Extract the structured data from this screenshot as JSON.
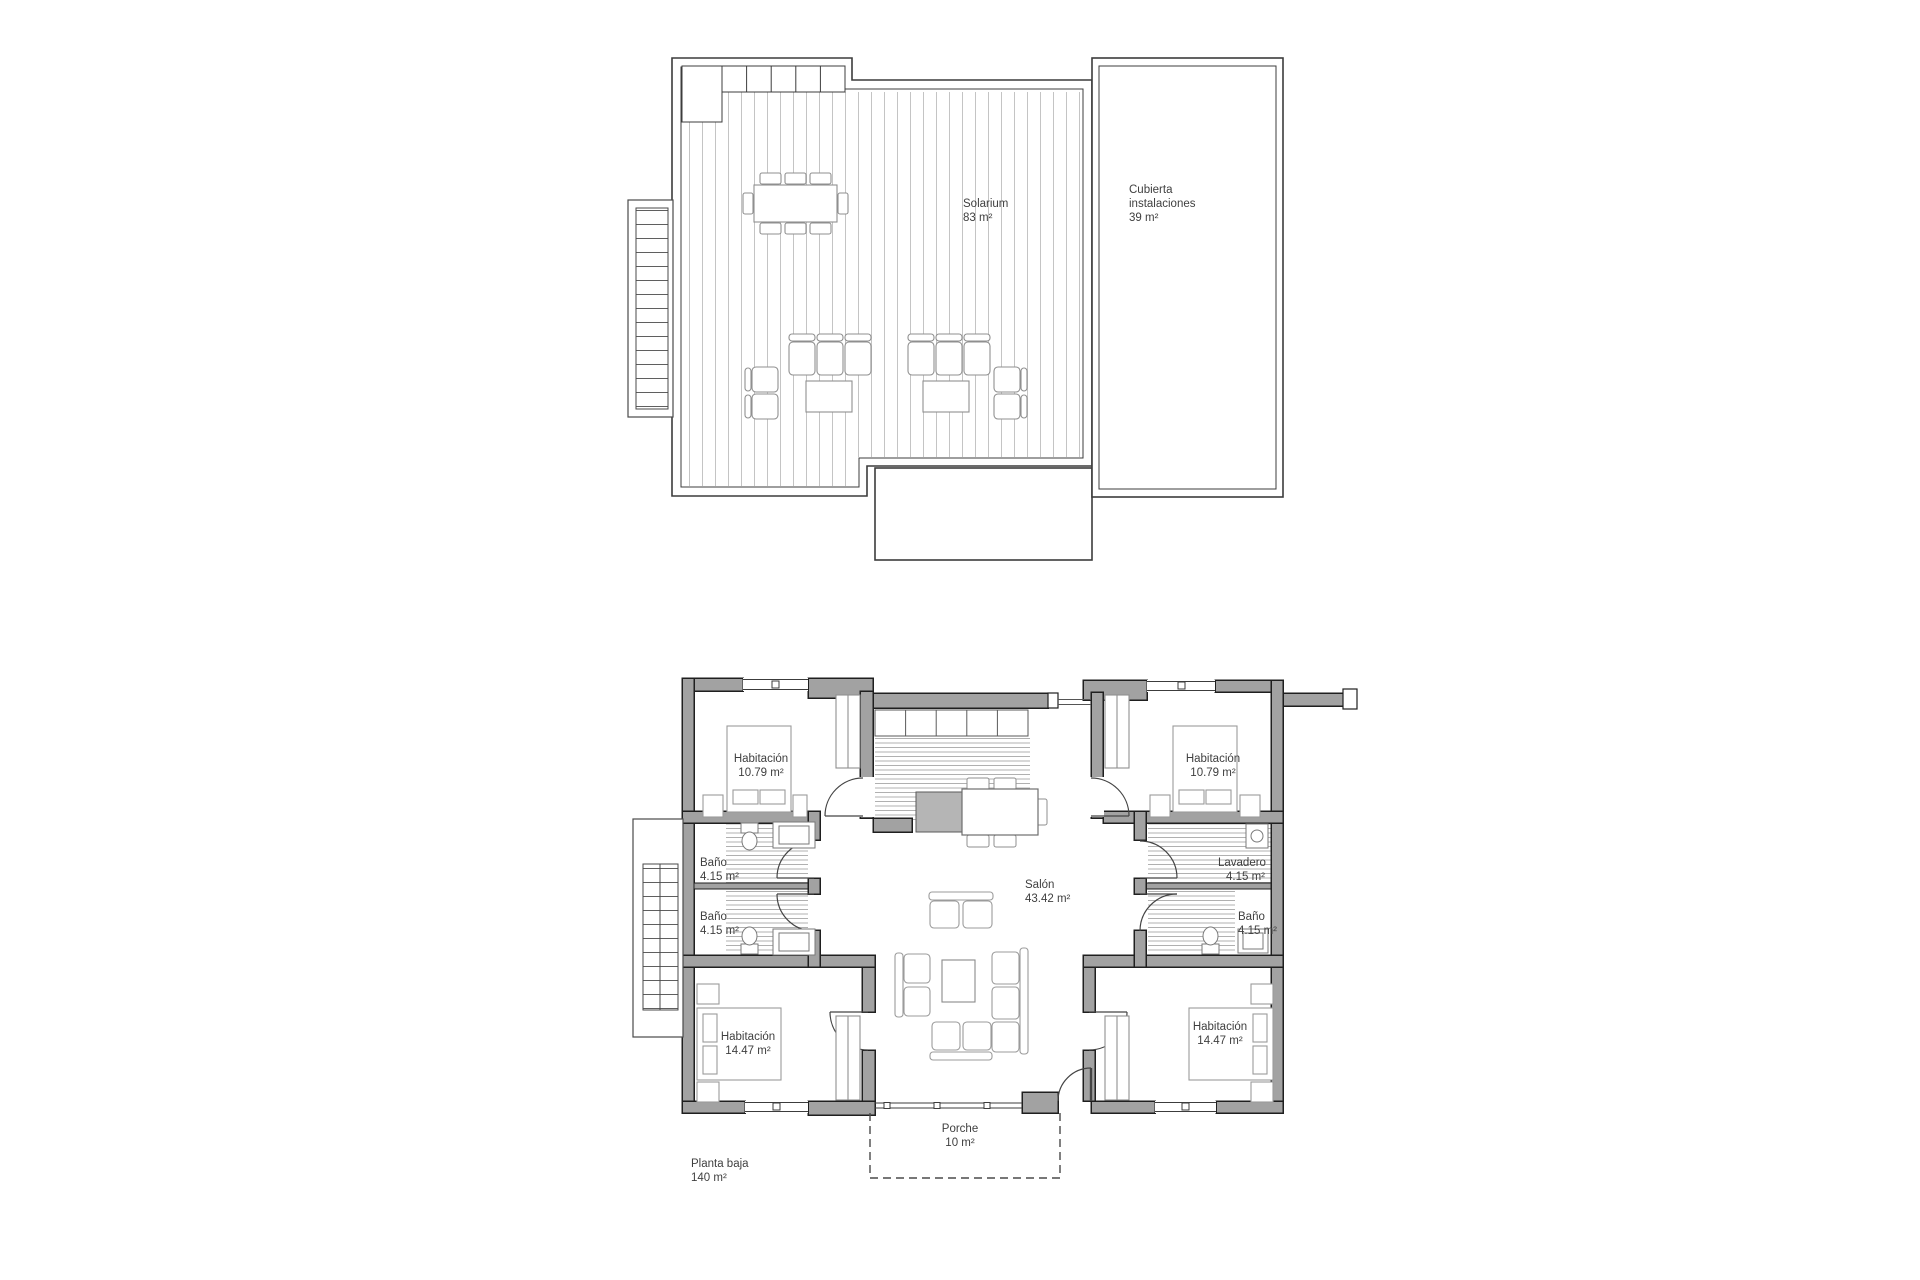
{
  "page": {
    "background": "#ffffff"
  },
  "colors": {
    "wall_fill": "#a2a2a2",
    "wall_outline": "#1f1f1f",
    "thin_line": "#3c3c3c",
    "furniture_line": "#8f8f8f",
    "text": "#3f3f3f",
    "deck_stripe": "#c4c4c4",
    "tile_stripe": "#b0b0b0"
  },
  "roof_plan": {
    "solarium": {
      "name": "Solarium",
      "area": "83 m²"
    },
    "cubierta": {
      "line1": "Cubierta",
      "line2": "instalaciones",
      "area": "39 m²"
    }
  },
  "ground_plan": {
    "title": {
      "name": "Planta baja",
      "area": "140 m²"
    },
    "rooms": {
      "bedroom_top_left": {
        "name": "Habitación",
        "area": "10.79 m²"
      },
      "bedroom_top_right": {
        "name": "Habitación",
        "area": "10.79 m²"
      },
      "bath_upper_left": {
        "name": "Baño",
        "area": "4.15 m²"
      },
      "bath_lower_left": {
        "name": "Baño",
        "area": "4.15 m²"
      },
      "laundry": {
        "name": "Lavadero",
        "area": "4.15 m²"
      },
      "bath_right": {
        "name": "Baño",
        "area": "4.15 m²"
      },
      "bedroom_bottom_left": {
        "name": "Habitación",
        "area": "14.47 m²"
      },
      "bedroom_bottom_right": {
        "name": "Habitación",
        "area": "14.47 m²"
      },
      "living_room": {
        "name": "Salón",
        "area": "43.42 m²"
      },
      "porch": {
        "name": "Porche",
        "area": "10 m²"
      }
    }
  }
}
